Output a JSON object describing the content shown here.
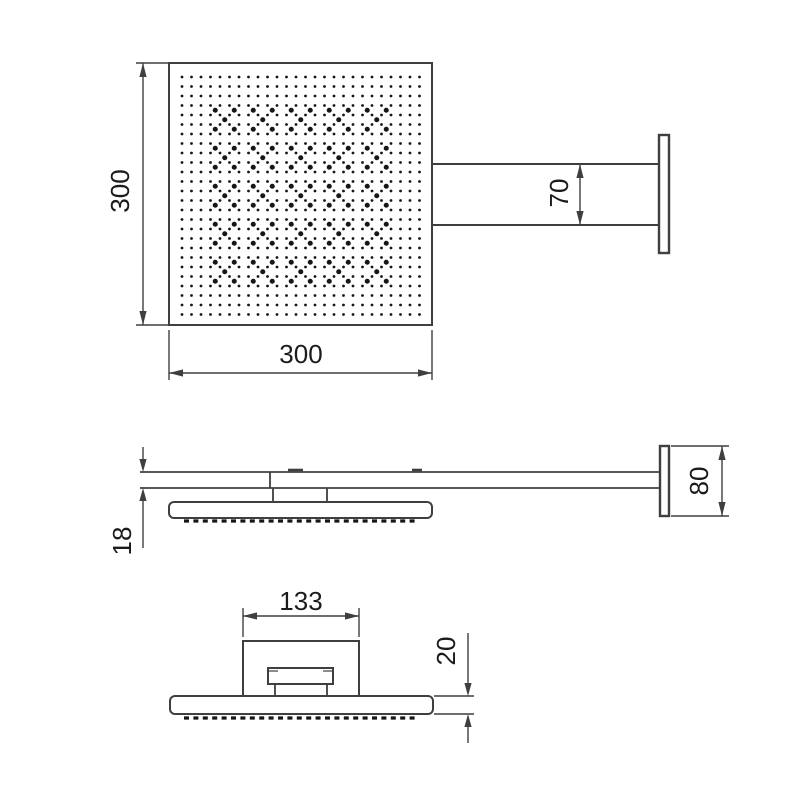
{
  "drawing": {
    "type": "technical-dimension-drawing",
    "subject": "square-rain-shower-head-with-wall-arm",
    "views": {
      "top": {
        "dims": {
          "head_height": "300",
          "head_width": "300",
          "arm_width": "70"
        }
      },
      "side": {
        "dims": {
          "arm_thickness": "18",
          "flange_height": "80"
        }
      },
      "front": {
        "dims": {
          "bracket_width": "133",
          "plate_thickness": "20"
        }
      }
    }
  },
  "colors": {
    "background": "#ffffff",
    "line": "#3f3f3f",
    "text": "#1b1b1b",
    "nozzle": "#161616"
  },
  "nozzles": {
    "grid_cols": 26,
    "grid_rows": 26,
    "accent_min": 3,
    "accent_max": 21,
    "accent_period": 4
  }
}
